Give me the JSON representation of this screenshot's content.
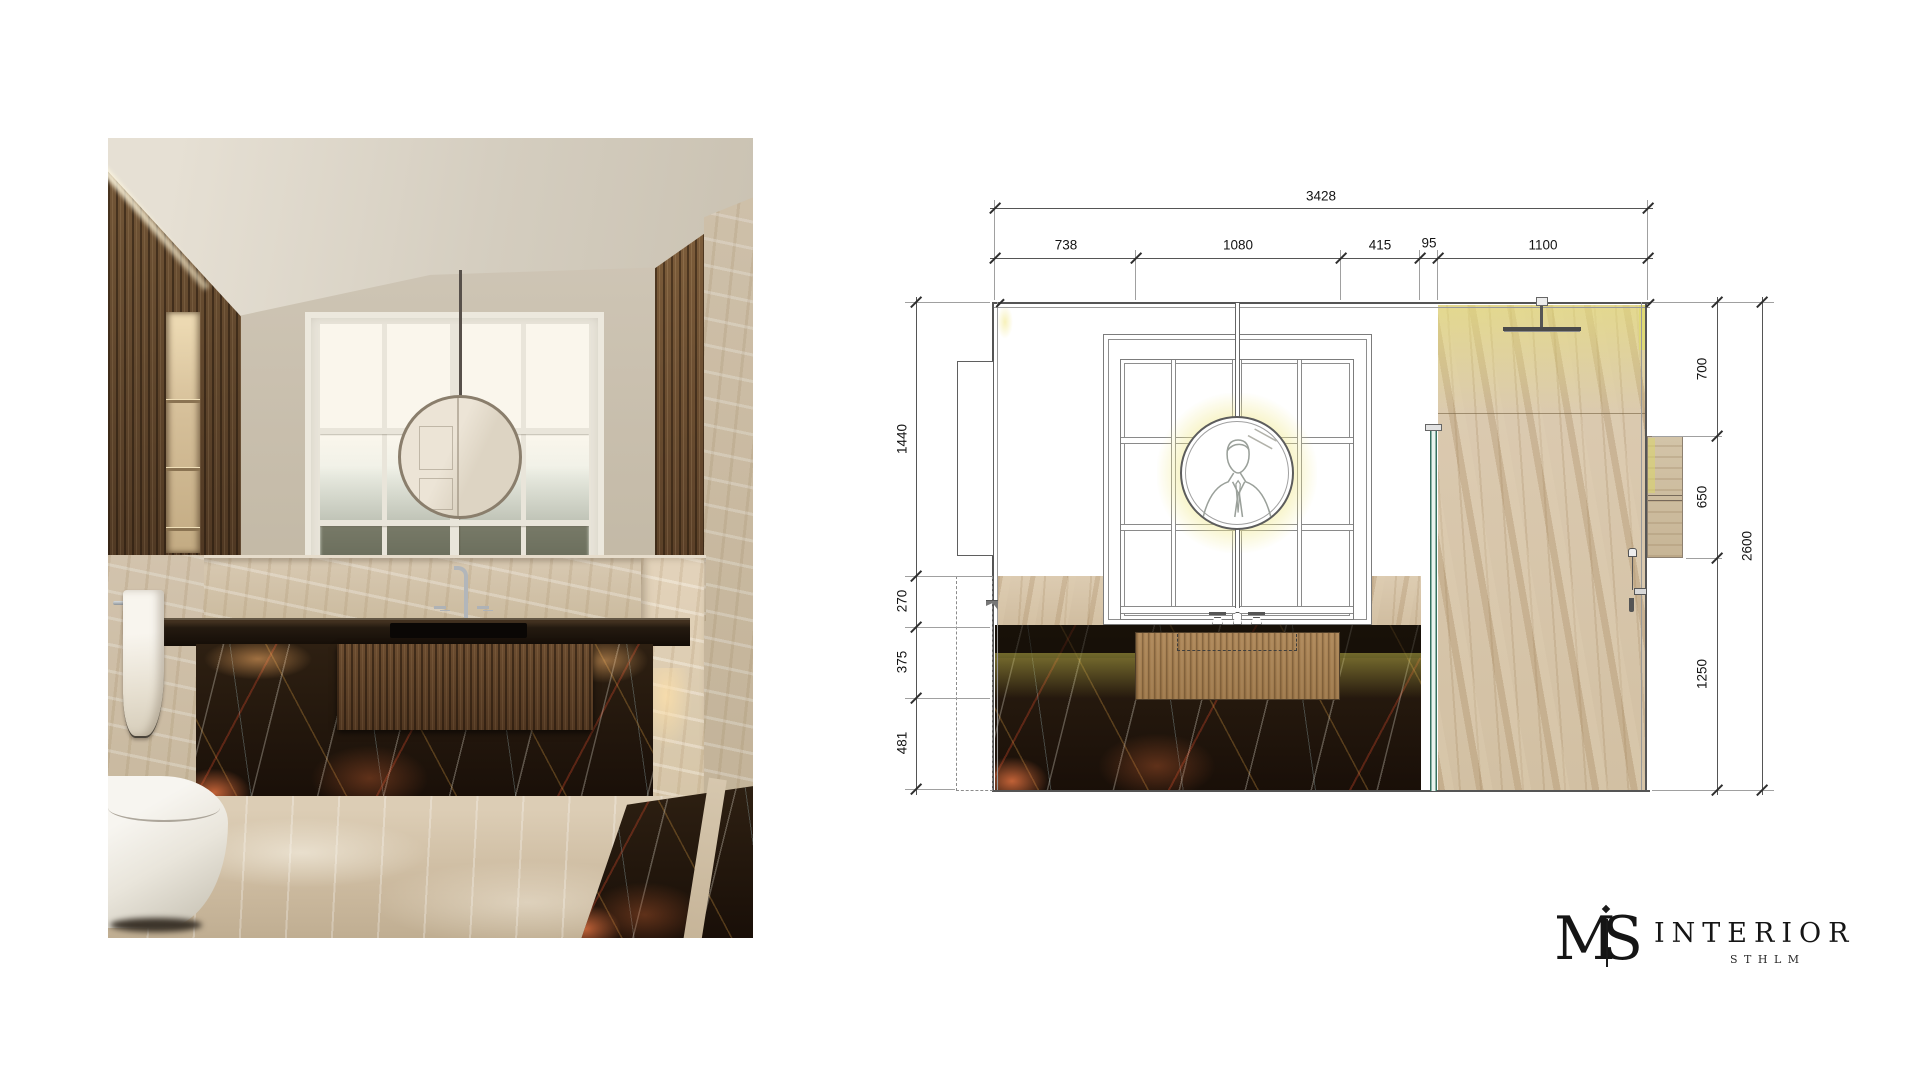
{
  "elevation": {
    "top": {
      "total": "3428",
      "segments": [
        "738",
        "1080",
        "415",
        "95",
        "1100"
      ]
    },
    "left": [
      "1440",
      "270",
      "375",
      "481"
    ],
    "right": {
      "segments": [
        "700",
        "650",
        "1250"
      ],
      "total": "2600"
    }
  },
  "logo": {
    "monogram_m": "M",
    "monogram_s": "S",
    "word": "INTERIOR",
    "city": "STHLM"
  },
  "colors": {
    "line": "#555555",
    "glow_yellow": "#ece28a",
    "glass_teal": "#356e60",
    "marble_dark": "#1f150c",
    "marble_beige": "#d6c5aa",
    "wood": "#a07b50",
    "logo_ink": "#1a1a1a"
  }
}
